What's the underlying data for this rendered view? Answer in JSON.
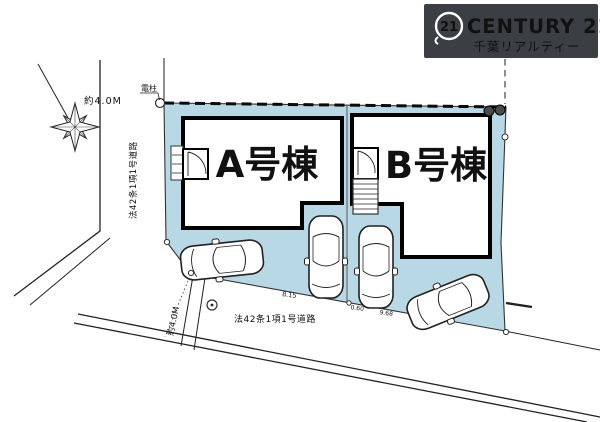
{
  "logo": {
    "seal": "21",
    "brand": "CENTURY 21",
    "company": "千葉リアルティー"
  },
  "plan": {
    "building_a_label": "A号棟",
    "building_b_label": "B号棟",
    "west_road": {
      "width": "約4.0M",
      "name": "法42条1項1号道路"
    },
    "south_road": {
      "width": "約4.0M",
      "name": "法42条1項1号道路"
    },
    "utility_pole_label": "電柱",
    "dims": {
      "d1": "8.15",
      "d2": "0.60",
      "d3": "9.68"
    }
  },
  "colors": {
    "lot_fill": "#b7d8e4",
    "logo_bg": "#3b3e43",
    "line": "#1c1c1c"
  }
}
